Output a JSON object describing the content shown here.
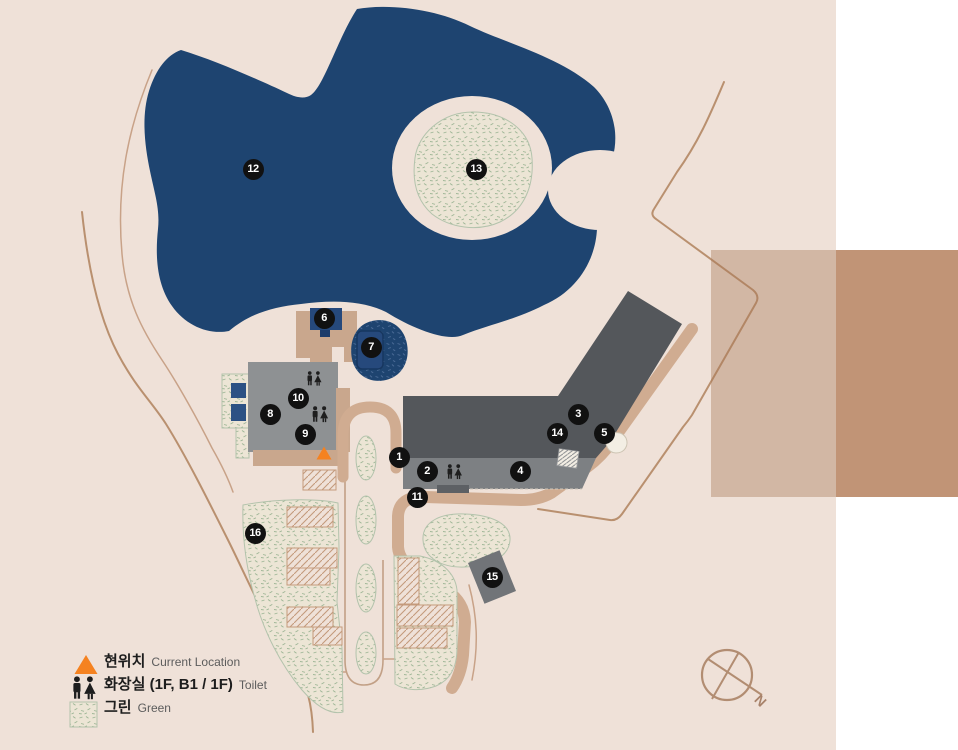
{
  "map": {
    "description": "Facility site map with pond, buildings, golf greens, numbered location markers",
    "markers": [
      {
        "n": "1",
        "x": 399,
        "y": 457
      },
      {
        "n": "2",
        "x": 427,
        "y": 471
      },
      {
        "n": "3",
        "x": 578,
        "y": 414
      },
      {
        "n": "4",
        "x": 520,
        "y": 471
      },
      {
        "n": "5",
        "x": 604,
        "y": 433
      },
      {
        "n": "6",
        "x": 324,
        "y": 318
      },
      {
        "n": "7",
        "x": 371,
        "y": 347
      },
      {
        "n": "8",
        "x": 270,
        "y": 414
      },
      {
        "n": "9",
        "x": 305,
        "y": 434
      },
      {
        "n": "10",
        "x": 298,
        "y": 398
      },
      {
        "n": "11",
        "x": 417,
        "y": 497
      },
      {
        "n": "12",
        "x": 253,
        "y": 169
      },
      {
        "n": "13",
        "x": 476,
        "y": 169
      },
      {
        "n": "14",
        "x": 557,
        "y": 433
      },
      {
        "n": "15",
        "x": 492,
        "y": 577
      },
      {
        "n": "16",
        "x": 255,
        "y": 533
      }
    ],
    "legend": {
      "items": [
        {
          "icon": "current-location-icon",
          "ko": "현위치",
          "en": "Current Location"
        },
        {
          "icon": "toilet-icon",
          "ko": "화장실 (1F, B1 / 1F)",
          "en": "Toilet"
        },
        {
          "icon": "green-swatch-icon",
          "ko": "그린",
          "en": "Green"
        }
      ]
    },
    "compass": {
      "label": "N"
    },
    "colors": {
      "map_bg": "#efe1d8",
      "lake": "#1e4470",
      "building_dark": "#54575b",
      "building_mid": "#7d8083",
      "building_gray": "#8e9193",
      "deck": "#c9a78d",
      "road": "#d0ac91",
      "line": "#b9906f",
      "line_light": "#c8a288",
      "green_outline": "#b3c3ac",
      "green_speckle": "#9db595",
      "hatch": "#c49a7c",
      "navy": "#26497c",
      "navy_dark": "#1d3c6a",
      "window": "#2c5184",
      "overlay_light": "#d3b7a5",
      "overlay_dark": "#c19476",
      "orange": "#f58220",
      "marker_bg": "#111111",
      "marker_text": "#ffffff",
      "text_dark": "#1d1d1d",
      "text_gray": "#5c5c5c",
      "compass": "#b28d72",
      "block": "#717478"
    }
  }
}
